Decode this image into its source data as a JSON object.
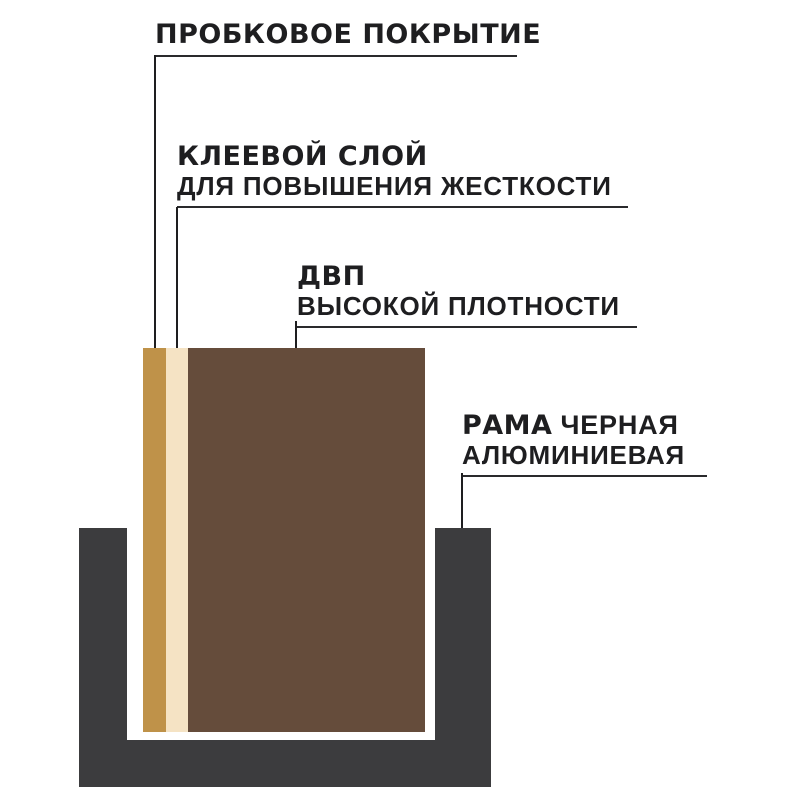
{
  "labels": {
    "cork": {
      "title": "ПРОБКОВОЕ ПОКРЫТИЕ"
    },
    "glue": {
      "title": "КЛЕЕВОЙ СЛОЙ",
      "subtitle": "ДЛЯ ПОВЫШЕНИЯ ЖЕСТКОСТИ"
    },
    "hdf": {
      "title": "ДВП",
      "subtitle": "ВЫСОКОЙ ПЛОТНОСТИ"
    },
    "frame": {
      "title": "РАМА",
      "title_rest": "ЧЕРНАЯ",
      "subtitle": "АЛЮМИНИЕВАЯ"
    }
  },
  "colors": {
    "cork_layer": "#bf9249",
    "glue_layer": "#f5e3c4",
    "hdf_layer": "#654c3b",
    "frame": "#3c3c3e",
    "leader_line": "#1e1e20",
    "text": "#1e1e20",
    "background": "#ffffff"
  }
}
